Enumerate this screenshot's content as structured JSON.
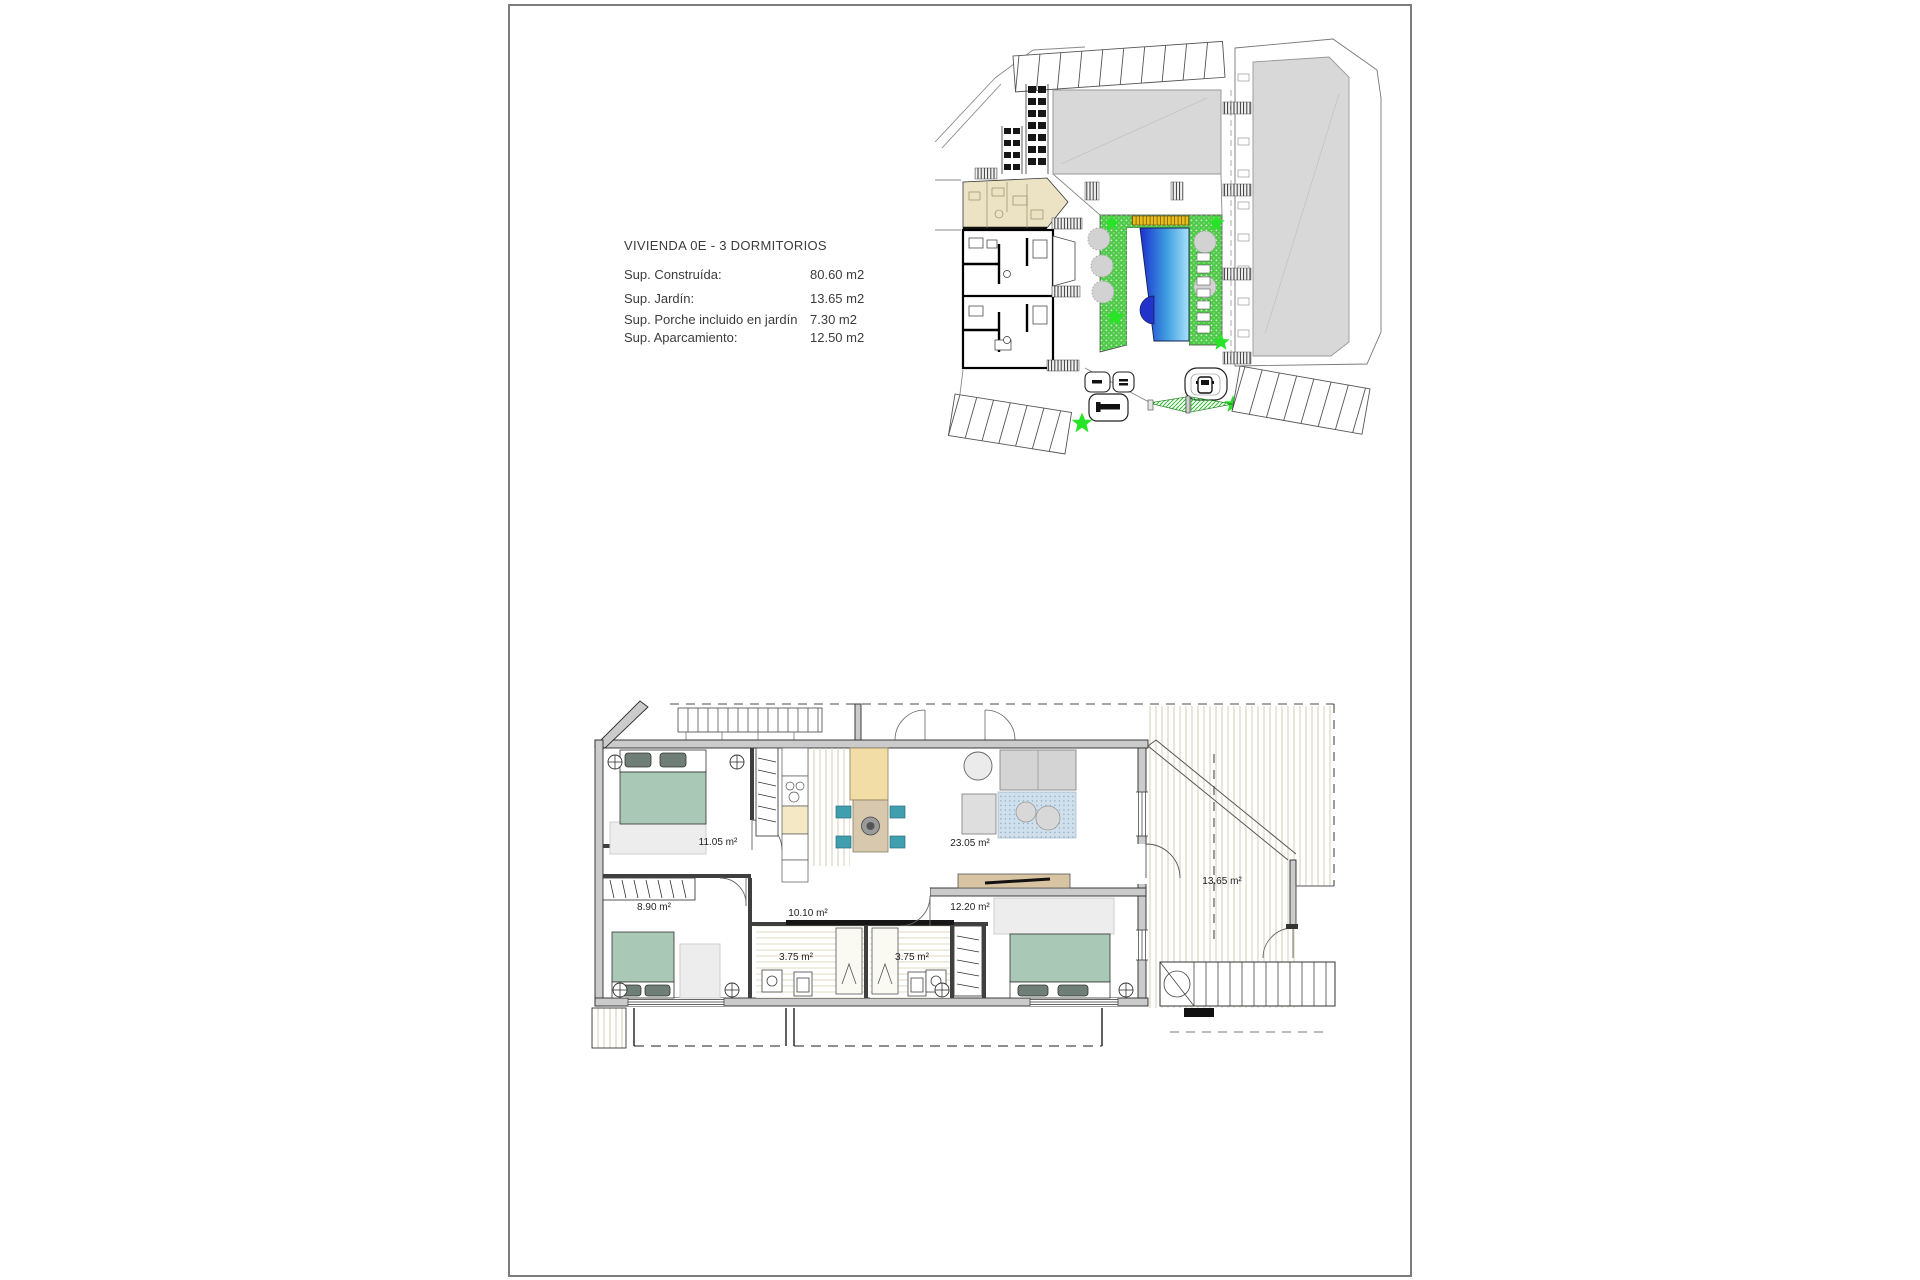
{
  "page": {
    "background": "#ffffff",
    "border_color": "#7c7c7c"
  },
  "info": {
    "title": "VIVIENDA 0E - 3 DORMITORIOS",
    "rows": [
      {
        "label": "Sup. Construída:",
        "value": "80.60 m2"
      },
      {
        "label": "Sup. Jardín:",
        "value": "13.65 m2"
      },
      {
        "label": "Sup. Porche incluido en jardín",
        "value": "7.30 m2"
      },
      {
        "label": "Sup. Aparcamiento:",
        "value": "12.50 m2"
      }
    ]
  },
  "site_plan": {
    "colors": {
      "pool_dark": "#1a2fd0",
      "pool_mid": "#3f9fe0",
      "pool_light": "#a8e0fb",
      "deck_green": "#4ec948",
      "star_green": "#27e427",
      "highlight_unit_beige": "#ece3c4",
      "building_gray": "#d8d8d8",
      "sunshade_yellow": "#e8bd1e"
    }
  },
  "floor_plan": {
    "rooms": [
      {
        "name": "bedroom-1",
        "area": "11.05 m²"
      },
      {
        "name": "bedroom-2",
        "area": "8.90 m²"
      },
      {
        "name": "hallway",
        "area": "10.10 m²"
      },
      {
        "name": "bathroom-1",
        "area": "3.75 m²"
      },
      {
        "name": "bathroom-2",
        "area": "3.75 m²"
      },
      {
        "name": "bedroom-3",
        "area": "12.20 m²"
      },
      {
        "name": "living-kitchen",
        "area": "23.05 m²"
      },
      {
        "name": "terrace",
        "area": "13.65 m²"
      }
    ],
    "colors": {
      "bed_green": "#a9c8b5",
      "rug_gray": "#ededed",
      "island_tan": "#f2dda6",
      "chair_teal": "#3f9fae",
      "tv_board_tan": "#d8c3a2",
      "wall_gray": "#cbcbcb",
      "blue_rug": "#cfe0ec"
    }
  }
}
